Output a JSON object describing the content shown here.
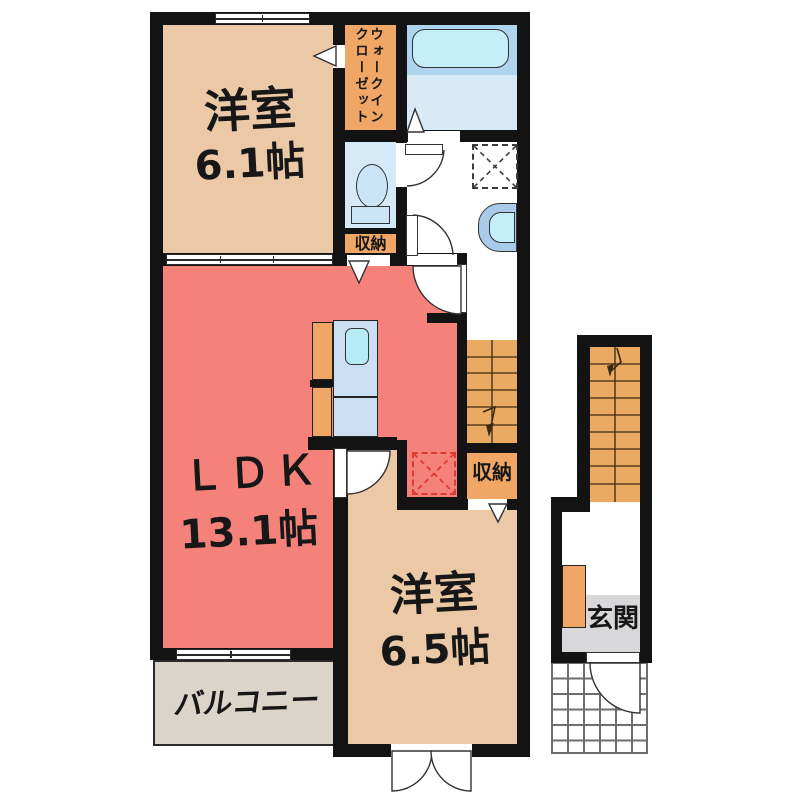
{
  "floorplan": {
    "rooms": {
      "bedroom1": {
        "name": "洋室",
        "size": "6.1帖"
      },
      "ldk": {
        "name": "ＬＤＫ",
        "size": "13.1帖"
      },
      "bedroom2": {
        "name": "洋室",
        "size": "6.5帖"
      },
      "wic": {
        "line1": "ウォークイン",
        "line2": "クローゼット"
      },
      "storage_by_toilet": {
        "name": "収納"
      },
      "storage_by_stairs": {
        "name": "収納"
      },
      "balcony": {
        "name": "バルコニー"
      },
      "entrance": {
        "name": "玄関"
      }
    },
    "icons": [
      "bathtub-icon",
      "toilet-icon",
      "washer-space-icon",
      "vanity-sink-icon",
      "kitchen-counter-icon",
      "kitchen-sink-icon",
      "refrigerator-space-icon",
      "stairs-up-icon",
      "stairs-down-icon",
      "door-swing-icon",
      "sliding-window-icon",
      "folding-door-icon",
      "entry-tile-icon",
      "shoe-cabinet-icon"
    ],
    "colors": {
      "wall": "#131313",
      "ldk_floor": "#F4817A",
      "bedroom_floor": "#EBC9A6",
      "closet_orange": "#F0A765",
      "stairs_orange": "#EBAA62",
      "bath_upper": "#AED5ED",
      "bath_lower": "#D9EAF7",
      "bathtub": "#C4EFF8",
      "toilet_room": "#D6E9F7",
      "kitchen_counter": "#CBDFF2",
      "balcony_floor": "#DAD4C9",
      "entrance_floor": "#D8D8DB",
      "refrigerator_marker": "#E03A30"
    }
  }
}
